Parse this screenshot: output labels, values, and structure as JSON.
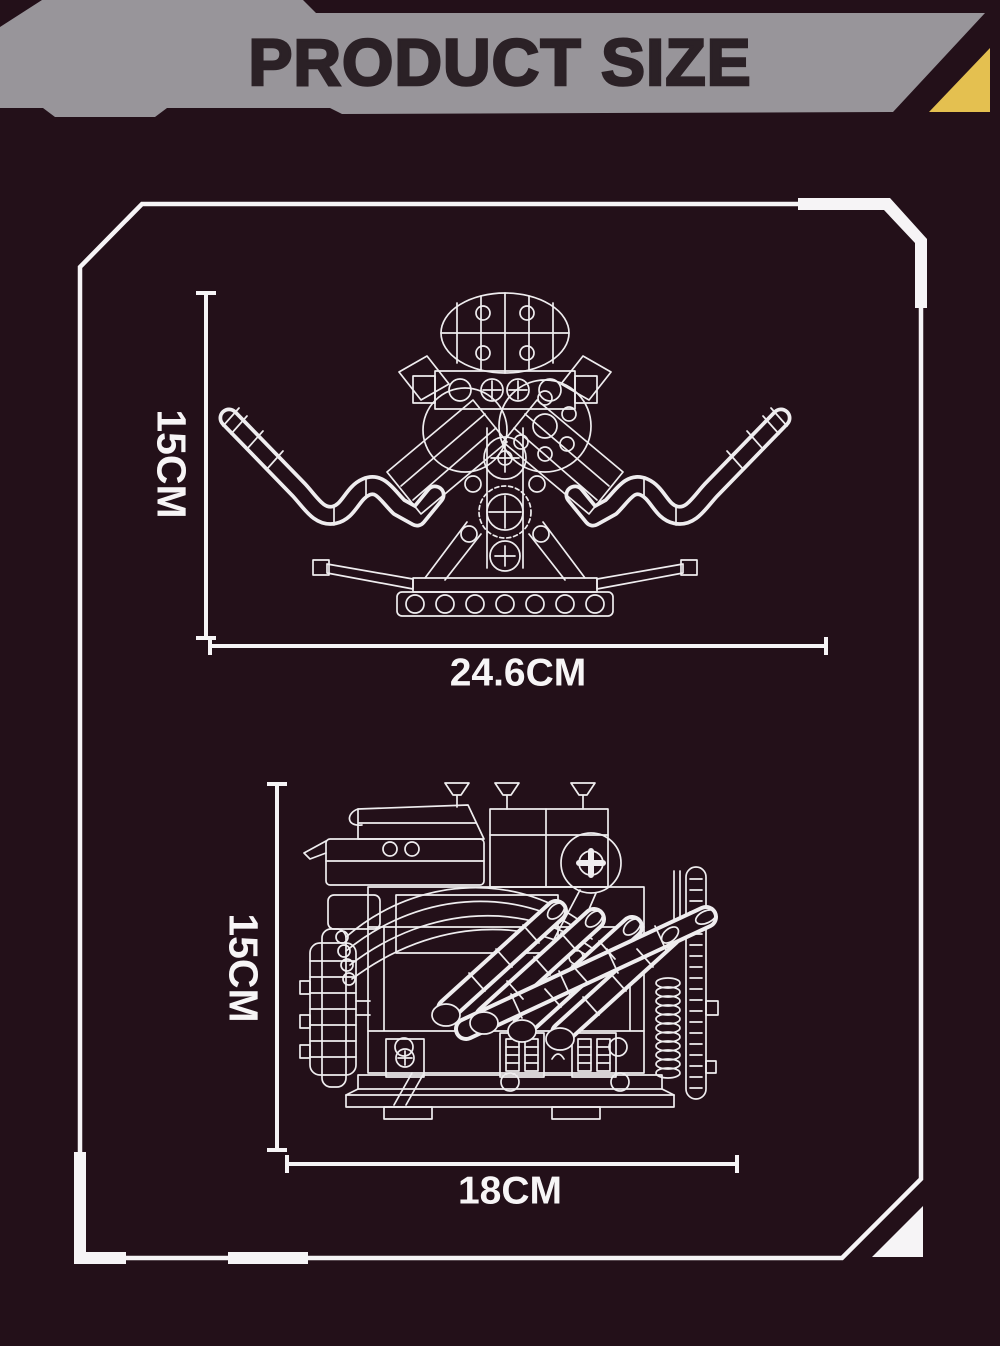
{
  "header": {
    "title": "PRODUCT SIZE",
    "colors": {
      "banner_gray": "#98959a",
      "title_text": "#2b2126",
      "accent_triangle": "#e4c050",
      "background": "#231019",
      "line_white": "#f6f4f6"
    }
  },
  "panel": {
    "diagrams": [
      {
        "id": "engine-front-view",
        "height_label": "15CM",
        "width_label": "24.6CM"
      },
      {
        "id": "engine-side-view",
        "height_label": "15CM",
        "width_label": "18CM"
      }
    ]
  }
}
